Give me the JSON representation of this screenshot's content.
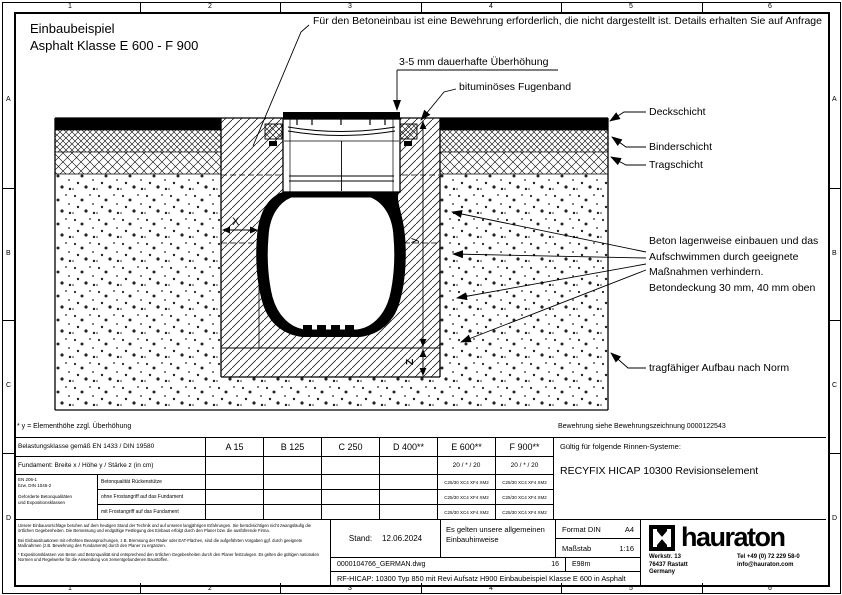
{
  "sheet": {
    "border_cols": [
      "1",
      "2",
      "3",
      "4",
      "5",
      "6"
    ],
    "border_rows": [
      "A",
      "B",
      "C",
      "D"
    ]
  },
  "drawing": {
    "title1": "Einbaubeispiel",
    "title2": "Asphalt Klasse E 600 - F 900",
    "note_reinforcement": "Für den Betoneinbau ist eine Bewehrung erforderlich, die nicht dargestellt ist. Details erhalten Sie auf Anfrage",
    "note_overheight": "3-5 mm dauerhafte Überhöhung",
    "note_joint_band": "bituminöses Fugenband",
    "label_deck": "Deckschicht",
    "label_binder": "Binderschicht",
    "label_trag": "Tragschicht",
    "note_concrete": "Beton lagenweise einbauen und das Aufschwimmen durch geeignete Maßnahmen verhindern. Betondeckung 30 mm, 40 mm oben",
    "note_subbase": "tragfähiger Aufbau nach Norm",
    "dim_x": "X",
    "dim_y": "y",
    "dim_z": "Z",
    "footnote": "* y = Elementhöhe zzgl. Überhöhung",
    "note_rebar": "Bewehrung siehe Bewehrungszeichnung 0000122543"
  },
  "table": {
    "class_row_label": "Belastungsklasse gemäß EN 1433 / DIN 19580",
    "classes": [
      "A 15",
      "B 125",
      "C 250",
      "D 400**",
      "E 600**",
      "F 900**"
    ],
    "foundation_row_label": "Fundament: Breite x / Höhe y / Stärke z (in cm)",
    "foundation_e600": "20 / * / 20",
    "foundation_f900": "20 / * / 20",
    "std_line1": "EN 206-1",
    "std_line2": "bzw. DIN 1045-2",
    "std_note1": "Geforderte Betonqualitäten",
    "std_note2": "und Expositionsklassen",
    "concrete_rows": [
      {
        "label": "Betonqualität Rückenstütze",
        "e600": "C25/30 XC4 XF4 XM2",
        "f900": "C25/30 XC4 XF4 XM2"
      },
      {
        "label": "ohne Frostangriff auf das Fundament",
        "e600": "C25/30 XC4 XF4 XM2",
        "f900": "C25/30 XC4 XF4 XM2"
      },
      {
        "label": "mit Frostangriff auf das Fundament",
        "e600": "C25/30 XC4 XF4 XM2",
        "f900": "C25/30 XC4 XF4 XM2"
      }
    ],
    "systems_label": "Gültig für folgende Rinnen-Systeme:",
    "systems_value": "RECYFIX HICAP 10300 Revisionselement"
  },
  "titleblock": {
    "disclaimer1": "Unsere Einbauvorschläge beruhen auf dem heutigen Stand der Technik und auf unseren langjährigen Erfahrungen. Sie berücksichtigen nicht zwangsläufig die örtlichen Gegebenheiten. Die Bemessung und endgültige Festlegung des Einbaus erfolgt durch den Planer bzw. die ausführende Firma.",
    "disclaimer2": "Bei Einbausituationen mit erhöhten Beanspruchungen, z.B. Bremsung der Räder oder EAT-Flächen, sind die aufgeführten Vorgaben ggf. durch geeignete Maßnahmen (z.B. Bewehrung des Fundaments) durch den Planer zu ergänzen.",
    "disclaimer3": "* Expositionsklassen von Beton und Betonqualität sind entsprechend den örtlichen Gegebenheiten durch den Planer festzulegen. Es gelten die gültigen nationalen Normen und Regelwerke für die Anwendung von zementgebundenen Baustoffen.",
    "stand_label": "Stand:",
    "stand_value": "12.06.2024",
    "hint": "Es gelten unsere allgemeinen Einbauhinweise",
    "format_label": "Format DIN",
    "format_value": "A4",
    "scale_label": "Maßstab",
    "scale_value": "1:16",
    "file_name": "0000104766_GERMAN.dwg",
    "sheet_no": "16",
    "doc_code": "E98m",
    "drawing_title": "RF-HICAP: 10300 Typ 850 mit Revi Aufsatz H900 Einbaubeispiel Klasse E 600 in Asphalt",
    "brand": "hauraton",
    "addr1": "Werkstr. 13",
    "addr2": "76437 Rastatt",
    "addr3": "Germany",
    "tel": "Tel +49 (0) 72 229 58-0",
    "email": "info@hauraton.com"
  }
}
